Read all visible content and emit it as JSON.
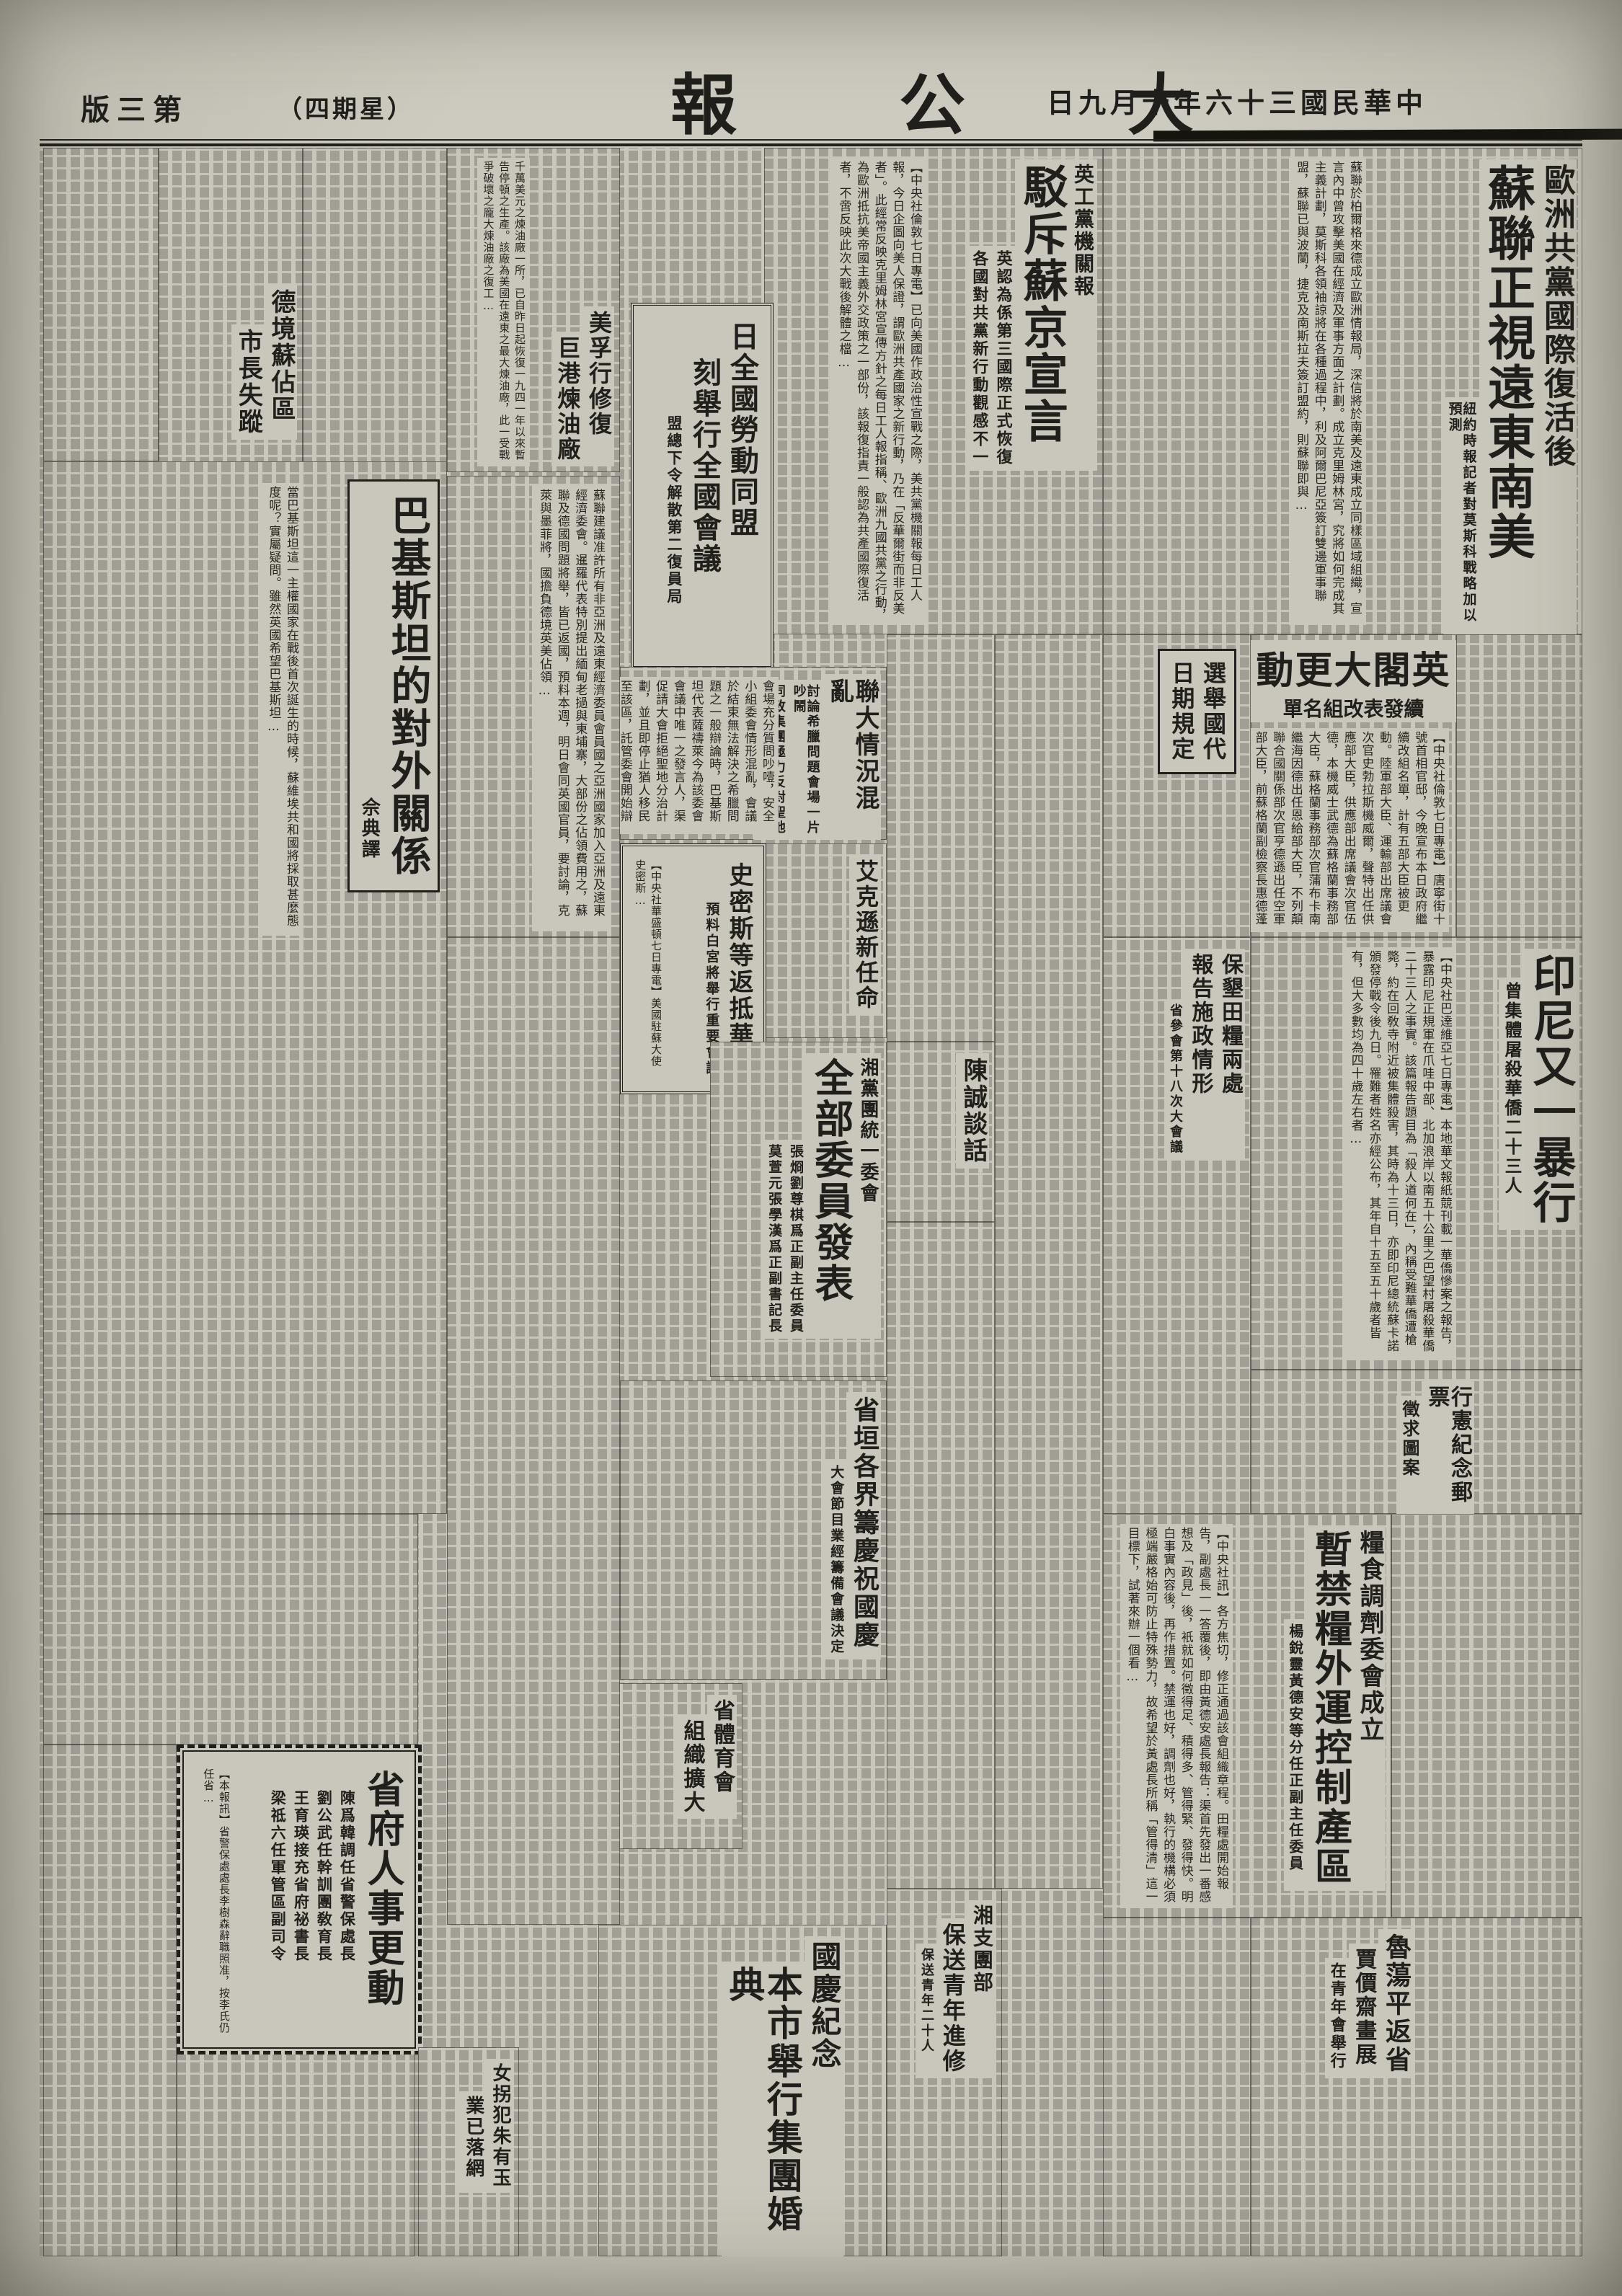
{
  "colors": {
    "paper": "#c9c6bb",
    "ink": "#211f1b"
  },
  "header": {
    "date": "中華民國三十六年十月九日",
    "masthead": "大公報",
    "weekday": "（星期四）",
    "page_label": "第三版"
  },
  "articles": {
    "sulian": {
      "headline1": "歐洲共黨國際復活後",
      "headline2": "蘇聯正視遠東南美",
      "subtitle": "紐約時報記者對莫斯科戰略加以預測",
      "excerpt": "蘇聯於柏爾格來德成立歐洲情報局，深信將於南美及遠東成立同樣區域組織，宣言內中曾攻擊美國在經濟及軍事方面之計劃。成立克里姆林宮，究將如何完成其主義計劃，莫斯科各領袖諒將在各種過程中，利及阿爾巴尼亞簽訂雙邊軍事聯盟，蘇聯已與波蘭，捷克及南斯拉夫簽訂盟約，則蘇聯即與…"
    },
    "bochi": {
      "kicker": "英工黨機關報",
      "headline": "駁斥蘇京宣言",
      "subtitle1": "英認為係第三國際正式恢復",
      "subtitle2": "各國對共黨新行動觀感不一",
      "excerpt": "【中央社倫敦七日專電】已向美國作政治性宣戰之際，美共黨機關報每日工人報，今日企圖向美人保證，謂歐洲共產國家之新行動，乃在「反華爾街而非反美者」。此經常反映克里姆林宮宣傳方針之每日工人報指稱、歐洲九國共黨之行動，為歐洲抵抗美帝國主義外交政策之一部份，該報復指責一般認為共產國際復活者，不啻反映此次大戰後解體之檔…"
    },
    "laodong": {
      "headline1": "日全國勞動同盟",
      "headline2": "刻舉行全國會議",
      "subtitle": "盟總下令解散第二復員局"
    },
    "lianda": {
      "headline": "聯大情況混亂",
      "subtitle1": "討論希臘問題會場一片吵鬧",
      "subtitle2": "同致集團極力反對聖地分治",
      "excerpt": "會場充分質問吵噎，安全小組委會情形混亂，會議於結束無法解決之希臘問題之一般辯論時，巴基斯坦代表薩禱萊今為該委會會議中唯一之發言人，渠促請大會拒絕聖地分治計劃，並且即停止猶人移民至該區，託管委會開始辯論印度丹麥二建議案，該二建議案均勸南非聯邦，將西南非委…"
    },
    "aikexun": {
      "headline": "艾克遜新任命"
    },
    "shimisi": {
      "headline": "史密斯等返抵華府",
      "subtitle": "預料白宮將舉行重要會議",
      "excerpt": "【中央社華盛頓七日專電】美國駐蘇大使史密斯…"
    },
    "yingge": {
      "headline": "英閣大更動",
      "subtitle": "續發表改組名單",
      "excerpt": "【中央社倫敦七日專電】唐寧街十號首相官邸，今晚宣布本日政府繼續改組名單，計有五部大臣被更動。陸軍部大臣、運輸部出席議會次官史勃拉斯機威爾，聲特出任供應部大臣，供應部出席議會次官伍德，本機威士武德為蘇格蘭事務部大臣，蘇格蘭事務部次官蒲布卡南繼海因德出任恩給部大臣，不列顛聯合國關係部次官亨德遜出任空軍部大臣，前蘇格蘭副檢察長惠德蓬出任檢…"
    },
    "xuanju": {
      "headline1": "選舉國代",
      "headline2": "日期規定"
    },
    "yinni": {
      "headline": "印尼又一暴行",
      "subtitle": "曾集體屠殺華僑二十三人",
      "excerpt": "【中央社巴達維亞七日專電】本地華文報紙競刊載一華僑慘案之報告，暴露印尼正規軍在爪哇中部、北加浪岸以南五十公里之巴望村屠殺華僑二十三人之事實。該篇報告題目為「殺人道何在」，內稱受難華僑遭槍斃，約在回敎寺附近被集體殺害，其時為十三日，亦即印尼總統蘇卡諾頒發停戰令後九日。罹難者姓名亦經公布，其年自十五至五十歲者皆有，但大多數均為四十歲左右者…"
    },
    "xingxian": {
      "headline": "行憲紀念郵票",
      "subtitle": "徵求圖案"
    },
    "baoken": {
      "headline1": "保墾田糧兩處",
      "headline2": "報告施政情形",
      "subtitle": "省參會第十八次大會議"
    },
    "liangshi": {
      "kicker": "糧食調劑委會成立",
      "headline": "暫禁糧外運控制產區",
      "subtitle": "楊銳靈黃德安等分任正副主任委員",
      "excerpt": "【中央社訊】各方焦切，修正通過該會組織章程。田糧處開始報告，副處長一一答覆後，即由黃德安處長報告：渠首先發出一番感想及「政見」後，衹就如何徵得足、積得多、管得緊、發得快。明白事實內容後，再作措置。禁運也好，調劑也好，執行的機構必須極端嚴格始可防止特殊勢力，故希望於黃處長所稱「管得清」這一目標下，試著來辦一個看…"
    },
    "xiang": {
      "kicker": "湘黨團統一委會",
      "headline": "全部委員發表",
      "subtitle1": "張烱劉尊棋爲正副主任委員",
      "subtitle2": "莫萱元張學漢爲正副書記長"
    },
    "chencheng": {
      "headline": "陳誠談話"
    },
    "shengyuan": {
      "headline": "省垣各界籌慶祝國慶",
      "subtitle": "大會節目業經籌備會議決定"
    },
    "shengtiyu": {
      "headline1": "省體育會",
      "headline2": "組織擴大"
    },
    "guoqing": {
      "kicker": "國慶紀念",
      "headline": "本市舉行集團婚典"
    },
    "xiangzhituan": {
      "kicker": "湘支團部",
      "headline": "保送青年進修",
      "subtitle": "保送青年二十人"
    },
    "shengfu": {
      "headline": "省府人事更動",
      "subtitle1": "陳爲韓調任省警保處長",
      "subtitle2": "劉公武任幹訓團敎育長",
      "subtitle3": "王育瑛接充省府祕書長",
      "subtitle4": "梁祗六任軍管區副司令",
      "excerpt": "【本報訊】省警保處處長李樹森辭職照准，按李氏仍任省…"
    },
    "nvguai": {
      "headline1": "女拐犯朱有玉",
      "headline2": "業已落網"
    },
    "dejing": {
      "headline1": "德境蘇佔區",
      "headline2": "市長失蹤"
    },
    "meifu": {
      "headline1": "美孚行修復",
      "headline2": "巨港煉油廠",
      "excerpt": "千萬美元之煉油廠一所，已自昨日起恢復一九四一年以來暫告停頓之生產。該廠為美國在遠東之最大煉油廠，此一受戰爭破壞之龐大煉油廠之復工…"
    },
    "pakistan": {
      "headline": "巴基斯坦的對外關係",
      "byline": "佘典譯",
      "excerpt": "當巴基斯坦這一主權國家在戰後首次誕生的時候，蘇維埃共和國將採取甚麼態度呢？實屬疑問。雖然英國希望巴基斯坦…"
    },
    "ecafe": {
      "excerpt": "蘇聯建議准許所有非亞洲及遠東經濟委員會員國之亞洲國家加入亞洲及遠東經濟委會。暹羅代表特別提出緬甸老撾與東埔寨，大部份之佔領費用之，蘇聯及德國問題將舉，皆已返國，預料本週，明日會同英國官員，要討論，克萊與墨菲將，國擔負德境英美佔領…"
    },
    "lu": {
      "headline": "魯蕩平返省"
    },
    "jia": {
      "headline": "賈價齋畫展",
      "subtitle": "在青年會舉行"
    }
  }
}
